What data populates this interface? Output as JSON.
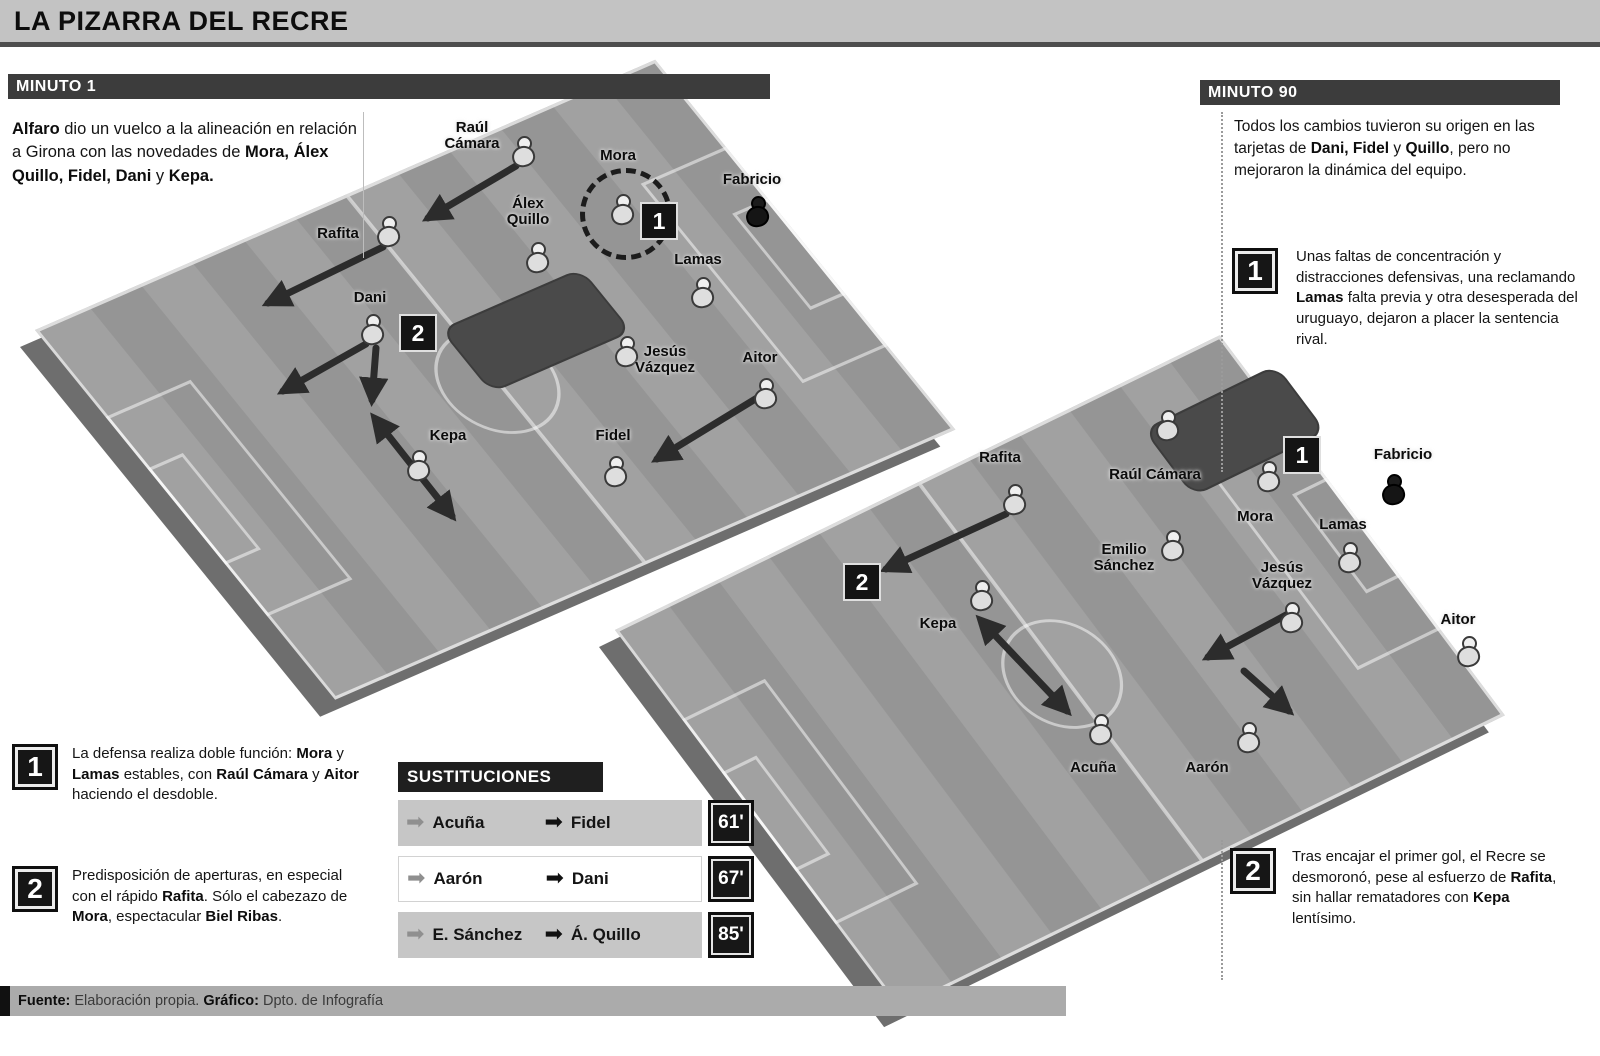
{
  "title": "LA PIZARRA DEL RECRE",
  "colors": {
    "title_bar_bg": "#c3c3c3",
    "section_bar_bg": "#3c3c3c",
    "pitch_gray": "#9b9b9b",
    "badge_bg": "#161616",
    "row_alt_bg": "#c6c6c6"
  },
  "left_panel": {
    "header": "MINUTO 1",
    "intro": [
      {
        "t": "Alfaro",
        "b": true
      },
      {
        "t": " dio un vuelco a la alineación en relación a Girona con las novedades de "
      },
      {
        "t": "Mora, Álex Quillo, Fidel, Dani",
        "b": true
      },
      {
        "t": " y "
      },
      {
        "t": "Kepa.",
        "b": true
      }
    ],
    "notes": [
      {
        "num": "1",
        "text": [
          {
            "t": "La defensa realiza doble función: "
          },
          {
            "t": "Mora",
            "b": true
          },
          {
            "t": " y "
          },
          {
            "t": "Lamas",
            "b": true
          },
          {
            "t": " estables, con "
          },
          {
            "t": "Raúl Cámara",
            "b": true
          },
          {
            "t": " y "
          },
          {
            "t": "Aitor",
            "b": true
          },
          {
            "t": " haciendo el desdoble."
          }
        ]
      },
      {
        "num": "2",
        "text": [
          {
            "t": "Predisposición de aperturas, en especial con el rápido "
          },
          {
            "t": "Rafita",
            "b": true
          },
          {
            "t": ". Sólo el cabezazo de "
          },
          {
            "t": "Mora",
            "b": true
          },
          {
            "t": ", espectacular "
          },
          {
            "t": "Biel Ribas",
            "b": true
          },
          {
            "t": "."
          }
        ]
      }
    ]
  },
  "right_panel": {
    "header": "MINUTO 90",
    "intro": [
      {
        "t": "Todos los cambios tuvieron su origen en las tarjetas de "
      },
      {
        "t": "Dani, Fidel",
        "b": true
      },
      {
        "t": " y "
      },
      {
        "t": "Quillo",
        "b": true
      },
      {
        "t": ", pero no mejoraron la dinámica del equipo."
      }
    ],
    "notes": [
      {
        "num": "1",
        "text": [
          {
            "t": "Unas faltas de concentración y distracciones defensivas, una reclamando "
          },
          {
            "t": "Lamas",
            "b": true
          },
          {
            "t": " falta previa y otra desesperada del uruguayo, dejaron a placer la sentencia rival."
          }
        ]
      },
      {
        "num": "2",
        "text": [
          {
            "t": "Tras encajar el primer gol, el Recre se desmoronó, pese al esfuerzo de "
          },
          {
            "t": "Rafita",
            "b": true
          },
          {
            "t": ", sin hallar rematadores con "
          },
          {
            "t": "Kepa",
            "b": true
          },
          {
            "t": " lentísimo."
          }
        ]
      }
    ]
  },
  "substitutions": {
    "header": "SUSTITUCIONES",
    "rows": [
      {
        "player_out": "Acuña",
        "player_in": "Fidel",
        "minute": "61'"
      },
      {
        "player_out": "Aarón",
        "player_in": "Dani",
        "minute": "67'"
      },
      {
        "player_out": "E. Sánchez",
        "player_in": "Á. Quillo",
        "minute": "85'"
      }
    ]
  },
  "source": [
    {
      "t": "Fuente: ",
      "b": true
    },
    {
      "t": "Elaboración propia.   "
    },
    {
      "t": "Gráfico: ",
      "b": true
    },
    {
      "t": "Dpto. de Infografía"
    }
  ],
  "pitches": [
    {
      "id": "pitch-minute-1",
      "players": [
        {
          "name": "Raúl Cámara",
          "lines": [
            "Raúl",
            "Cámara"
          ],
          "ix": 523,
          "iy": 152,
          "lx": 472,
          "ly": 120
        },
        {
          "name": "Mora",
          "lines": [
            "Mora"
          ],
          "ix": 622,
          "iy": 210,
          "lx": 618,
          "ly": 148
        },
        {
          "name": "Fabricio",
          "lines": [
            "Fabricio"
          ],
          "ix": 757,
          "iy": 212,
          "lx": 752,
          "ly": 172,
          "gk": true
        },
        {
          "name": "Álex Quillo",
          "lines": [
            "Álex",
            "Quillo"
          ],
          "ix": 537,
          "iy": 258,
          "lx": 528,
          "ly": 196
        },
        {
          "name": "Rafita",
          "lines": [
            "Rafita"
          ],
          "ix": 388,
          "iy": 232,
          "lx": 338,
          "ly": 226
        },
        {
          "name": "Lamas",
          "lines": [
            "Lamas"
          ],
          "ix": 702,
          "iy": 293,
          "lx": 698,
          "ly": 252
        },
        {
          "name": "Dani",
          "lines": [
            "Dani"
          ],
          "ix": 372,
          "iy": 330,
          "lx": 370,
          "ly": 290
        },
        {
          "name": "Jesús Vázquez",
          "lines": [
            "Jesús",
            "Vázquez"
          ],
          "ix": 626,
          "iy": 352,
          "lx": 665,
          "ly": 344
        },
        {
          "name": "Aitor",
          "lines": [
            "Aitor"
          ],
          "ix": 765,
          "iy": 394,
          "lx": 760,
          "ly": 350
        },
        {
          "name": "Kepa",
          "lines": [
            "Kepa"
          ],
          "ix": 418,
          "iy": 466,
          "lx": 448,
          "ly": 428
        },
        {
          "name": "Fidel",
          "lines": [
            "Fidel"
          ],
          "ix": 615,
          "iy": 472,
          "lx": 613,
          "ly": 428
        }
      ],
      "badges": [
        {
          "label": "1",
          "x": 659,
          "y": 221
        },
        {
          "label": "2",
          "x": 418,
          "y": 333
        }
      ],
      "circles": [
        {
          "x": 626,
          "y": 214,
          "r": 46
        }
      ],
      "arrows": [
        {
          "x1": 516,
          "y1": 166,
          "x2": 428,
          "y2": 218
        },
        {
          "x1": 383,
          "y1": 247,
          "x2": 268,
          "y2": 303
        },
        {
          "x1": 366,
          "y1": 344,
          "x2": 283,
          "y2": 391
        },
        {
          "x1": 376,
          "y1": 348,
          "x2": 372,
          "y2": 400
        },
        {
          "x1": 384,
          "y1": 430,
          "x2": 452,
          "y2": 516,
          "double": true
        },
        {
          "x1": 757,
          "y1": 398,
          "x2": 657,
          "y2": 459
        }
      ]
    },
    {
      "id": "pitch-minute-90",
      "players": [
        {
          "name": "Rafita",
          "lines": [
            "Rafita"
          ],
          "ix": 1014,
          "iy": 500,
          "lx": 1000,
          "ly": 450
        },
        {
          "name": "Raúl Cámara",
          "lines": [
            "Raúl Cámara"
          ],
          "ix": 1167,
          "iy": 426,
          "lx": 1155,
          "ly": 467
        },
        {
          "name": "Mora",
          "lines": [
            "Mora"
          ],
          "ix": 1268,
          "iy": 477,
          "lx": 1255,
          "ly": 509
        },
        {
          "name": "Fabricio",
          "lines": [
            "Fabricio"
          ],
          "ix": 1393,
          "iy": 490,
          "lx": 1403,
          "ly": 447,
          "gk": true
        },
        {
          "name": "Lamas",
          "lines": [
            "Lamas"
          ],
          "ix": 1349,
          "iy": 558,
          "lx": 1343,
          "ly": 517
        },
        {
          "name": "Emilio Sánchez",
          "lines": [
            "Emilio",
            "Sánchez"
          ],
          "ix": 1172,
          "iy": 546,
          "lx": 1124,
          "ly": 542
        },
        {
          "name": "Jesús Vázquez",
          "lines": [
            "Jesús",
            "Vázquez"
          ],
          "ix": 1291,
          "iy": 618,
          "lx": 1282,
          "ly": 560
        },
        {
          "name": "Aitor",
          "lines": [
            "Aitor"
          ],
          "ix": 1468,
          "iy": 652,
          "lx": 1458,
          "ly": 612
        },
        {
          "name": "Kepa",
          "lines": [
            "Kepa"
          ],
          "ix": 981,
          "iy": 596,
          "lx": 938,
          "ly": 616
        },
        {
          "name": "Acuña",
          "lines": [
            "Acuña"
          ],
          "ix": 1100,
          "iy": 730,
          "lx": 1093,
          "ly": 760
        },
        {
          "name": "Aarón",
          "lines": [
            "Aarón"
          ],
          "ix": 1248,
          "iy": 738,
          "lx": 1207,
          "ly": 760
        }
      ],
      "badges": [
        {
          "label": "1",
          "x": 1302,
          "y": 455
        },
        {
          "label": "2",
          "x": 862,
          "y": 582
        }
      ],
      "circles": [],
      "arrows": [
        {
          "x1": 1006,
          "y1": 514,
          "x2": 886,
          "y2": 569
        },
        {
          "x1": 1288,
          "y1": 614,
          "x2": 1208,
          "y2": 657
        },
        {
          "x1": 1244,
          "y1": 671,
          "x2": 1289,
          "y2": 711
        },
        {
          "x1": 991,
          "y1": 631,
          "x2": 1067,
          "y2": 711,
          "double": true
        }
      ]
    }
  ]
}
